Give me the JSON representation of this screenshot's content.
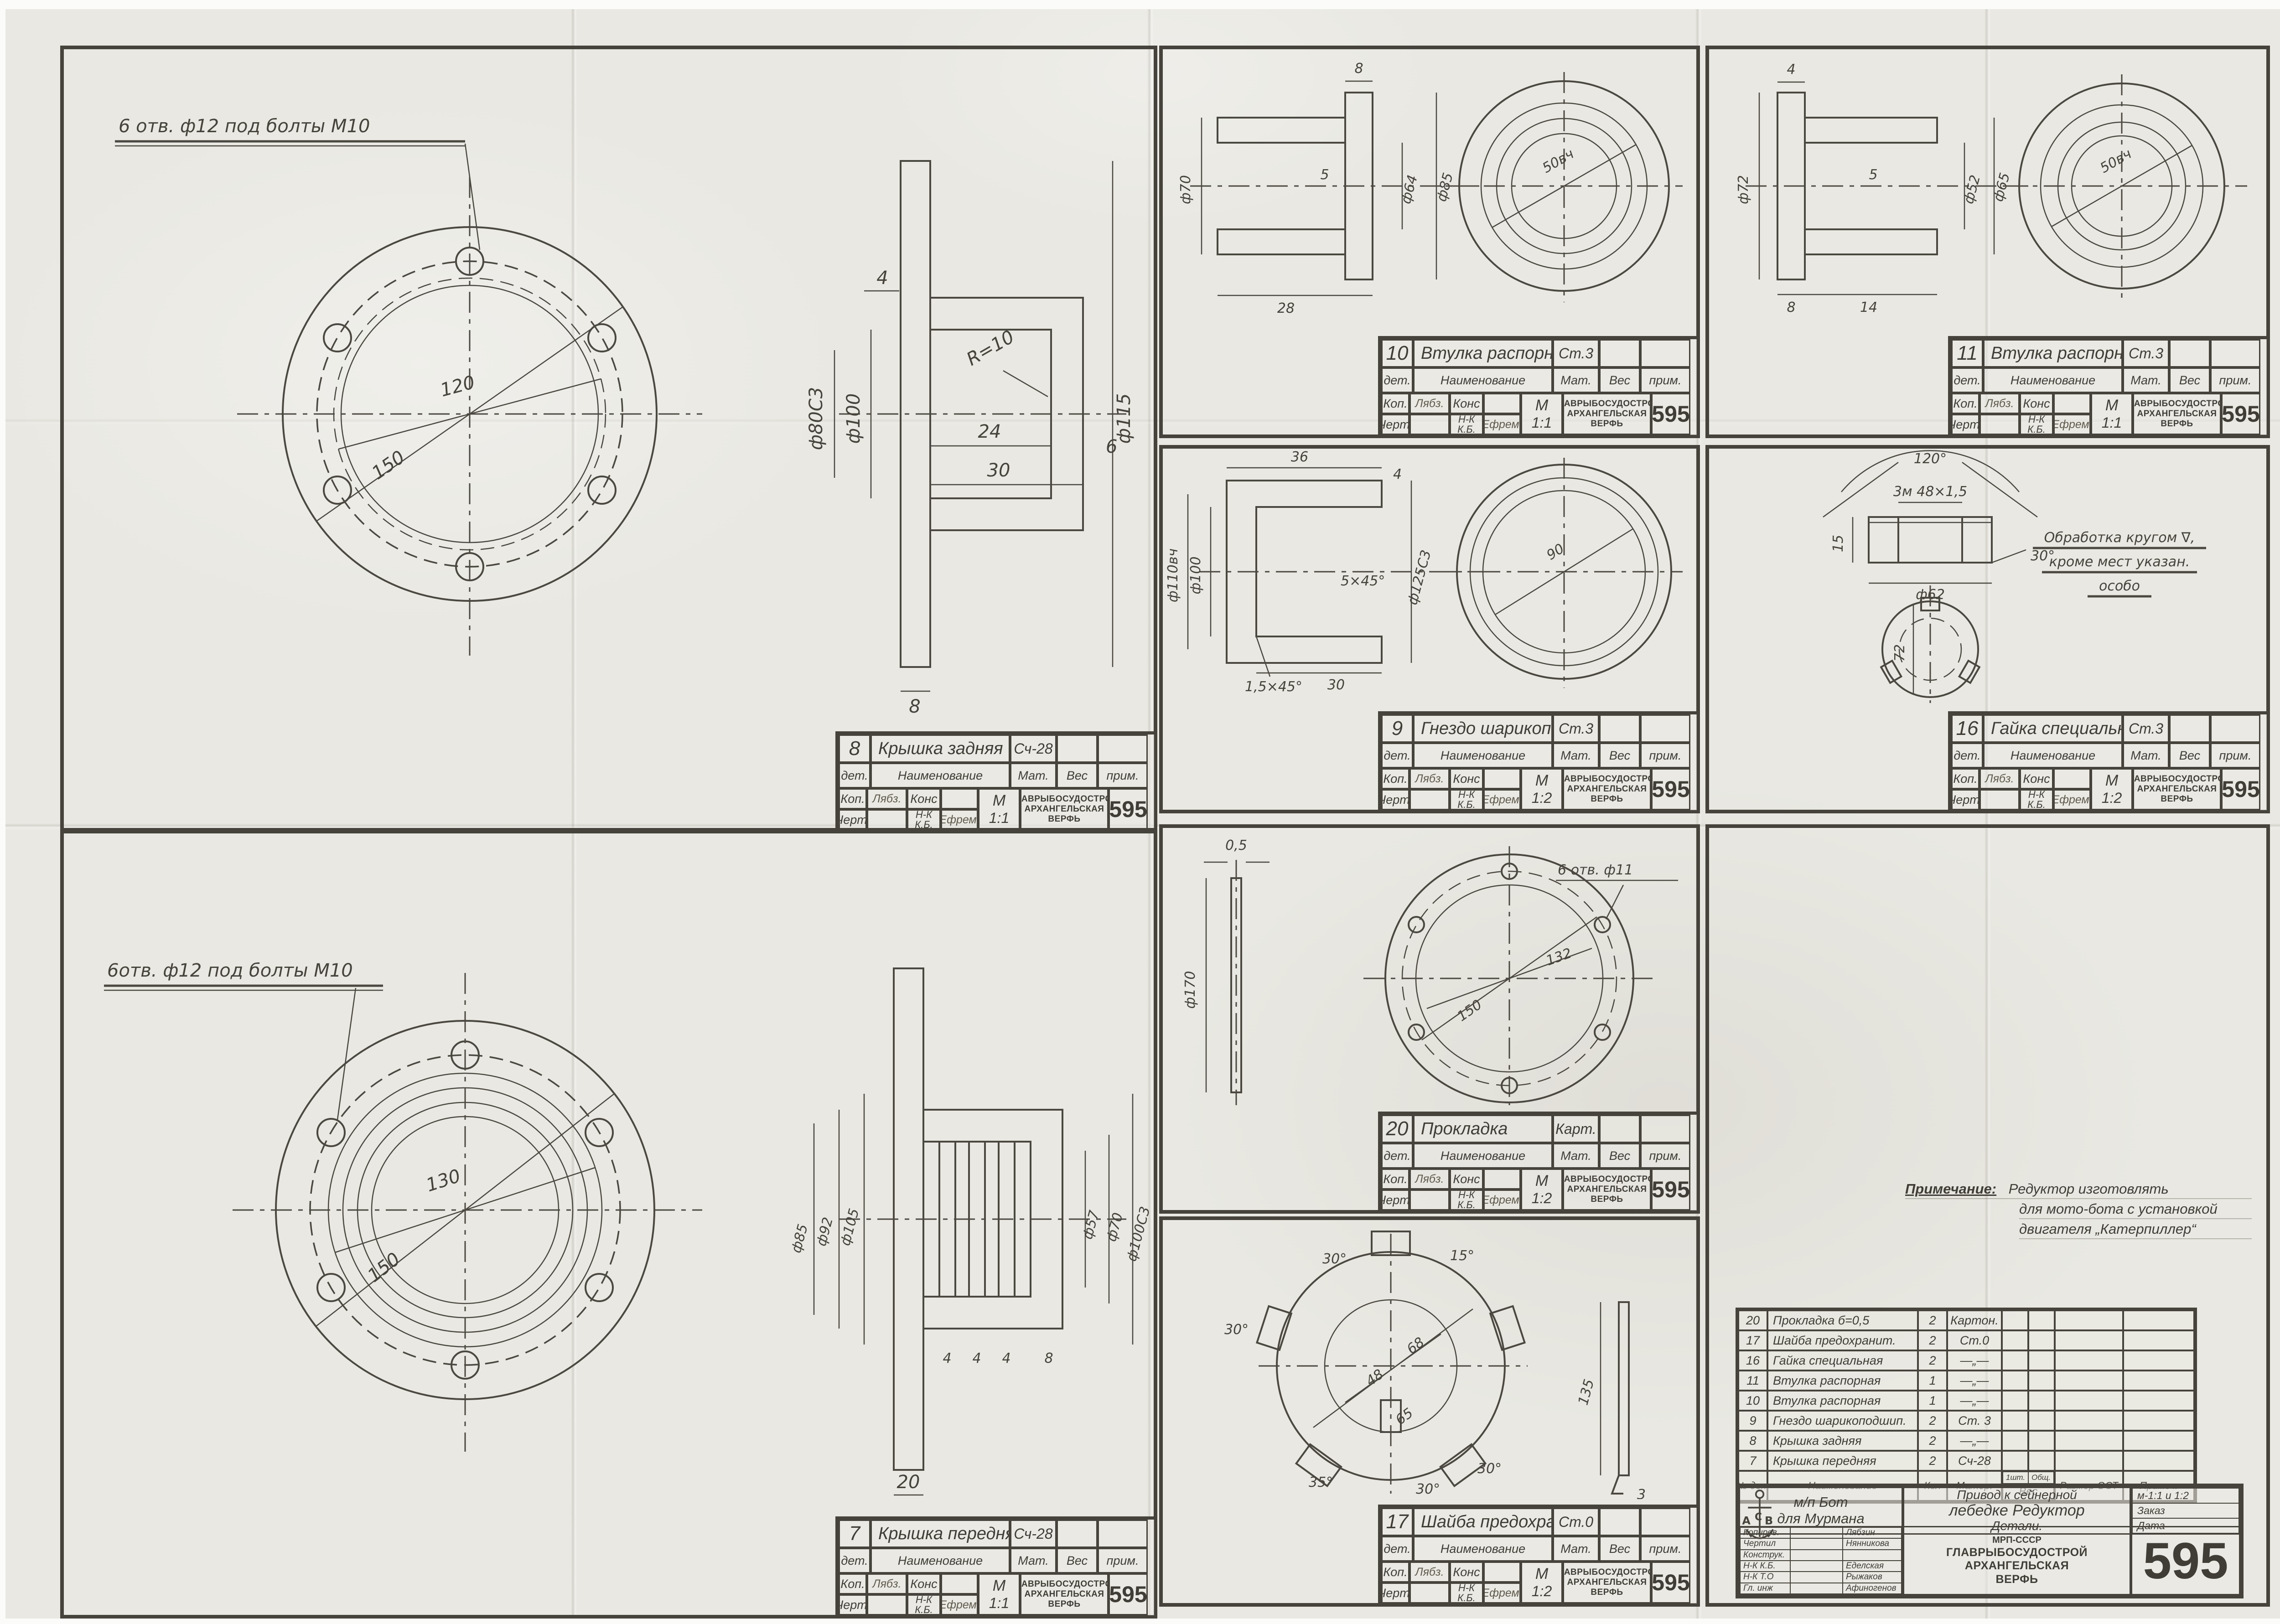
{
  "sheet": {
    "number": "595",
    "org": {
      "ministry": "МРП-СССР",
      "main": "ГЛАВРЫБОСУДОСТРОЙ",
      "city": "АРХАНГЕЛЬСКАЯ",
      "yard": "ВЕРФЬ",
      "logo": "АСВ"
    }
  },
  "tb_labels": {
    "det": "дет.",
    "naimen": "Наименование",
    "mat": "Мат.",
    "ves": "Вес",
    "prim": "прим.",
    "kop": "Коп.",
    "cher": "Черт.",
    "kons": "Конс",
    "nk": "Н-К К.Б.",
    "m": "М",
    "sig_kop": "Лябз.",
    "sig_nk": "Ефрем."
  },
  "panels": {
    "p8": {
      "num": "8",
      "title": "Крышка задняя",
      "mat": "Сч-28",
      "scale": "1:1",
      "note": "6 отв. ф12 под болты М10",
      "dims": [
        "120",
        "150",
        "ф80С3",
        "ф100",
        "ф115",
        "24",
        "30",
        "6",
        "4",
        "8",
        "R=10"
      ]
    },
    "p7": {
      "num": "7",
      "title": "Крышка передняя",
      "mat": "Сч-28",
      "scale": "1:1",
      "note": "6отв. ф12 под болты М10",
      "dims": [
        "130",
        "150",
        "ф105",
        "ф92",
        "ф85",
        "ф57",
        "ф70",
        "ф100С3",
        "4",
        "4",
        "4",
        "8",
        "20"
      ]
    },
    "p10": {
      "num": "10",
      "title": "Втулка распорная",
      "mat": "Ст.3",
      "scale": "1:1",
      "dims": [
        "8",
        "5",
        "ф70",
        "ф64",
        "ф85",
        "28",
        "50вч"
      ]
    },
    "p9": {
      "num": "9",
      "title": "Гнездо шарикоподш.",
      "mat": "Ст.3",
      "scale": "1:2",
      "dims": [
        "36",
        "4",
        "ф100",
        "ф110вч",
        "ф125С3",
        "5×45°",
        "1,5×45°",
        "30",
        "90"
      ]
    },
    "p20": {
      "num": "20",
      "title": "Прокладка",
      "mat": "Карт.",
      "scale": "1:2",
      "note": "6 отв. ф11",
      "dims": [
        "0,5",
        "ф170",
        "150",
        "132"
      ]
    },
    "p17": {
      "num": "17",
      "title": "Шайба предохранит.",
      "mat": "Ст.0",
      "scale": "1:2",
      "dims": [
        "30°",
        "15°",
        "30°",
        "68",
        "48",
        "65",
        "35°",
        "30°",
        "30°",
        "135",
        "3"
      ]
    },
    "p11": {
      "num": "11",
      "title": "Втулка распорная",
      "mat": "Ст.3",
      "scale": "1:1",
      "dims": [
        "4",
        "5",
        "ф72",
        "ф52",
        "ф65",
        "8",
        "14",
        "50вч"
      ]
    },
    "p16": {
      "num": "16",
      "title": "Гайка специальн.",
      "mat": "Ст.3",
      "scale": "1:2",
      "dims": [
        "120°",
        "3м 48×1,5",
        "15",
        "ф62",
        "30°",
        "72"
      ],
      "note_lines": [
        "Обработка кругом ∇,",
        "кроме мест указан.",
        "особо"
      ]
    }
  },
  "main": {
    "note_label": "Примечание:",
    "note_lines": [
      "Редуктор изготовлять",
      "для мото-бота с установкой",
      "двигателя „Катерпиллер“"
    ],
    "parts_header": {
      "num": "№ дет",
      "name": "Наименование",
      "qty": "Кол",
      "mat": "Матер.",
      "ves_1": "1шт.",
      "ves_2": "Общ.",
      "ves": "Вес",
      "size": "Размер ОСТ",
      "note": "Примеч."
    },
    "parts": [
      {
        "num": "20",
        "name": "Прокладка б=0,5",
        "qty": "2",
        "mat": "Картон."
      },
      {
        "num": "17",
        "name": "Шайба предохранит.",
        "qty": "2",
        "mat": "Ст.0"
      },
      {
        "num": "16",
        "name": "Гайка специальная",
        "qty": "2",
        "mat": "—„—"
      },
      {
        "num": "11",
        "name": "Втулка распорная",
        "qty": "1",
        "mat": "—„—"
      },
      {
        "num": "10",
        "name": "Втулка распорная",
        "qty": "1",
        "mat": "—„—"
      },
      {
        "num": "9",
        "name": "Гнездо шарикоподшип.",
        "qty": "2",
        "mat": "Ст. 3"
      },
      {
        "num": "8",
        "name": "Крышка задняя",
        "qty": "2",
        "mat": "—„—"
      },
      {
        "num": "7",
        "name": "Крышка передняя",
        "qty": "2",
        "mat": "Сч-28"
      }
    ],
    "project_line1": "м/п Бот",
    "project_line2": "для Мурмана",
    "assembly_line1": "Привод к сейнерной",
    "assembly_line2": "лебедке  Редуктор",
    "assembly_line3": "Детали.",
    "scale": "м-1:1 и 1:2",
    "zakaz": "Заказ",
    "date_label": "Дата",
    "roles": [
      {
        "role": "Копиров.",
        "name": "Лябзин"
      },
      {
        "role": "Чертил",
        "name": "Нянникова"
      },
      {
        "role": "Конструк.",
        "name": ""
      },
      {
        "role": "Н-К К.Б.",
        "name": "Еделская"
      },
      {
        "role": "Н-К Т.О",
        "name": "Рыжаков"
      },
      {
        "role": "Гл. инж",
        "name": "Афиногенов"
      }
    ]
  }
}
